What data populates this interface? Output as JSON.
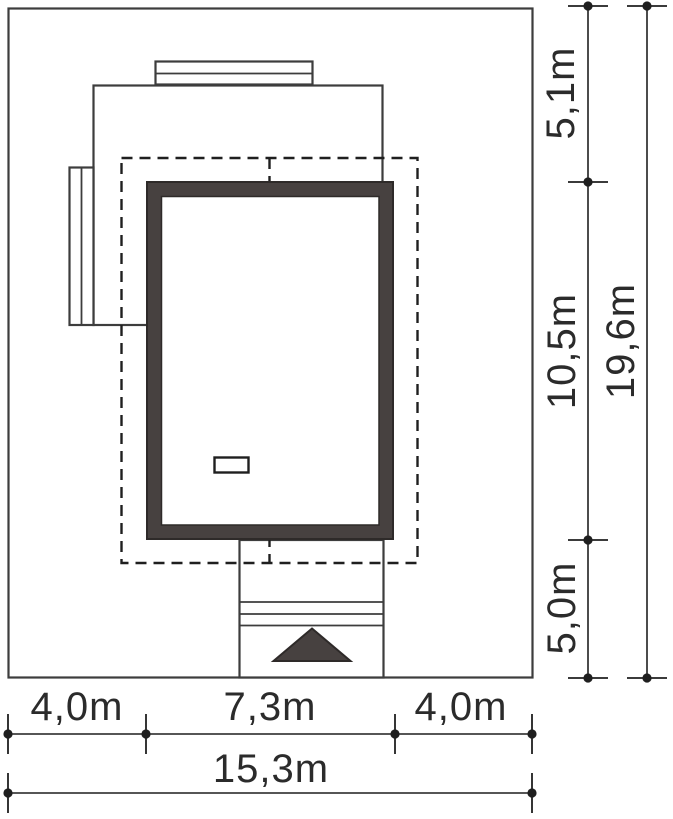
{
  "drawing": {
    "type": "architectural-site-plan",
    "dimensions": {
      "left_setback": "4,0m",
      "house_width": "7,3m",
      "right_setback": "4,0m",
      "plot_width_total": "15,3m",
      "top_setback": "5,1m",
      "house_depth": "10,5m",
      "bottom_setback": "5,0m",
      "plot_depth_total": "19,6m"
    },
    "icons": {
      "entrance_arrow": "filled-triangle-up"
    }
  },
  "colors": {
    "line": "#3d3d3d",
    "dash": "#1f1f1f",
    "dim": "#1f1f1f",
    "wall_fill": "#474140",
    "wall_stroke": "#2e2a29",
    "text": "#2b2b2b",
    "background": "#ffffff"
  }
}
